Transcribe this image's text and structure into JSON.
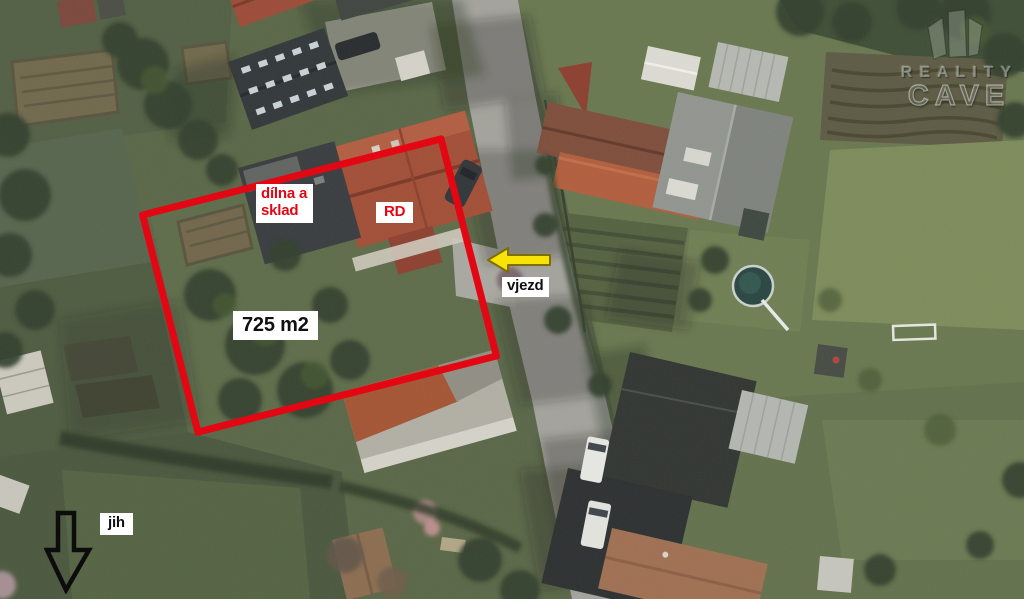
{
  "annotations": {
    "workshop": {
      "line1": "dílna a",
      "line2": "sklad"
    },
    "house": "RD",
    "area": "725 m2",
    "entrance": "vjezd",
    "south": "jih"
  },
  "watermark": {
    "line1": "REALITY",
    "line2": "CAVE"
  },
  "colors": {
    "annotation_red": "#e30613",
    "arrow_yellow": "#f8e208",
    "arrow_yellow_outline": "#7c6f00",
    "arrow_black": "#0c0c0c",
    "label_bg": "#ffffff",
    "label_text": "#101010"
  }
}
